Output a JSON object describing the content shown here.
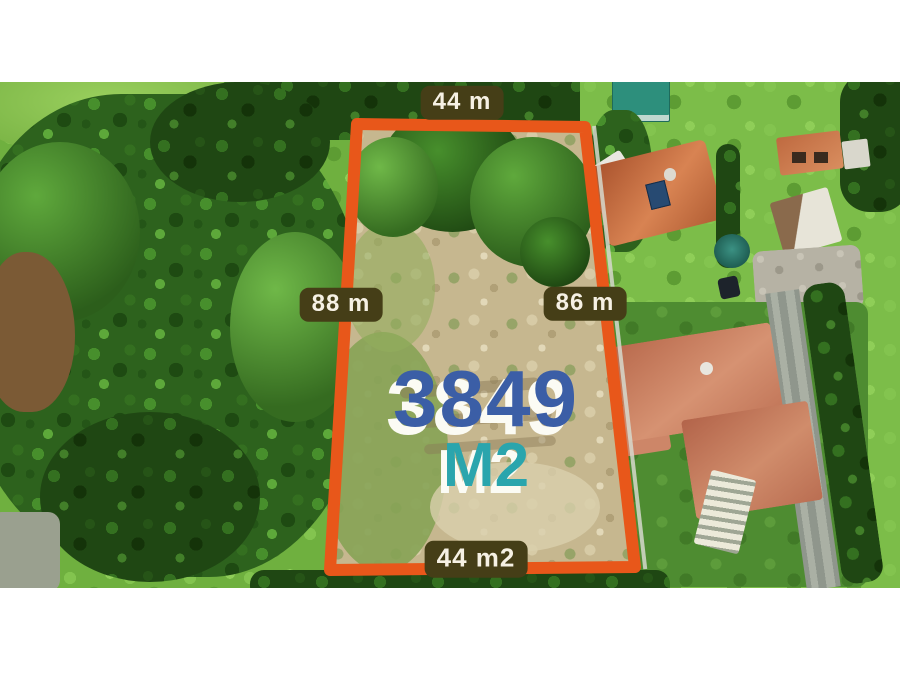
{
  "labels": {
    "top": "44 m",
    "left": "88 m",
    "right": "86 m",
    "bottom": "44 m2"
  },
  "area": {
    "value": "3849",
    "unit": "M2"
  },
  "colors": {
    "boundary": "#e8571a",
    "labelbg": "#453e17",
    "labeltext": "#f6f1e4",
    "areavalue": "#3b5ea6",
    "areaunit": "#2aa5ad",
    "letterbox": "#ffffff"
  }
}
